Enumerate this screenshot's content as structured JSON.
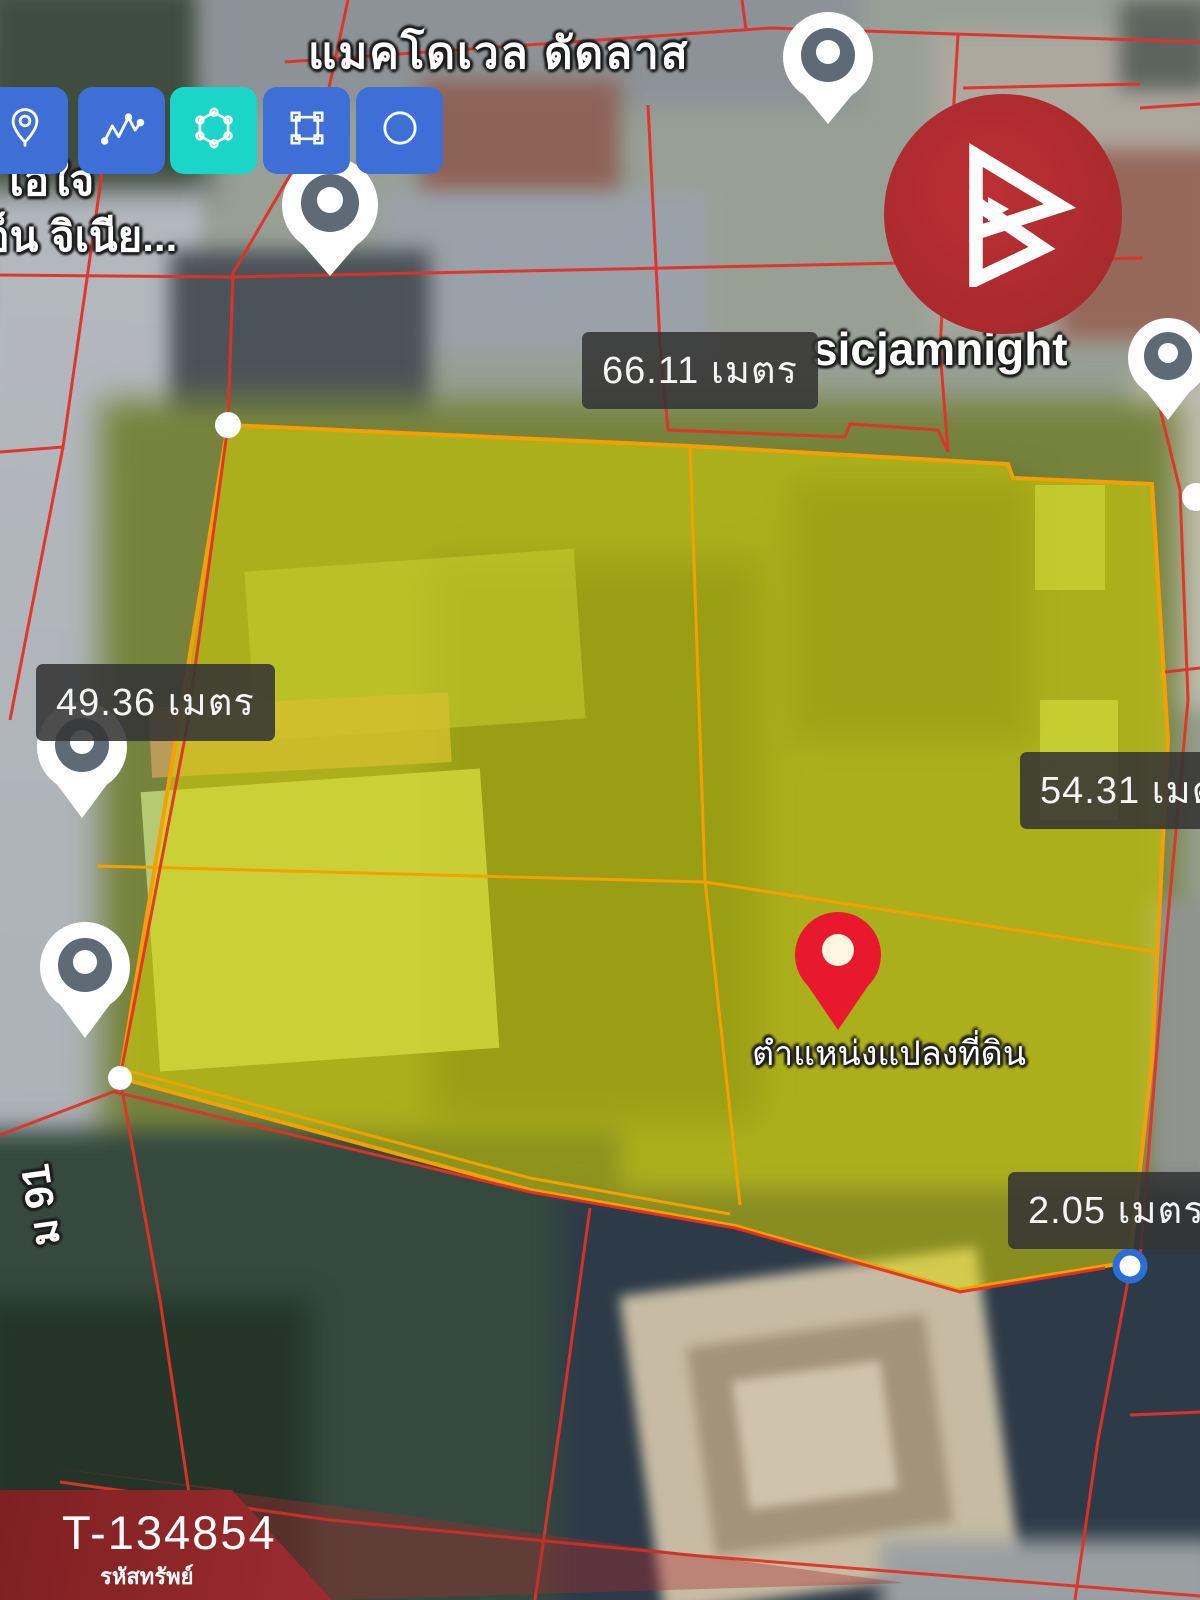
{
  "window": {
    "width": 1200,
    "height": 1600
  },
  "toolbar": {
    "button_color": "#3d6fd6",
    "active_color": "#1bd6c8",
    "tools": [
      {
        "id": "marker",
        "icon": "location-pin-icon",
        "active": false
      },
      {
        "id": "polyline",
        "icon": "polyline-icon",
        "active": false
      },
      {
        "id": "polygon",
        "icon": "polygon-icon",
        "active": true
      },
      {
        "id": "rectangle",
        "icon": "rectangle-icon",
        "active": false
      },
      {
        "id": "circle",
        "icon": "circle-icon",
        "active": false
      }
    ]
  },
  "map": {
    "street_label_top": "แมคโดเวล ดัดลาส",
    "place_label_right": "sicjamnight",
    "place_label_left_line1": "ล เอใจ",
    "place_label_left_line2": "เอ็น จิเนีย...",
    "road_label_left": "ม 91",
    "parcel_pin_label": "ตำแหน่งแปลงที่ดิน",
    "measurements": [
      {
        "side": "top",
        "text": "66.11 เมตร"
      },
      {
        "side": "left",
        "text": "49.36 เมตร"
      },
      {
        "side": "right",
        "text": "54.31 เมตร"
      },
      {
        "side": "bottom",
        "text": "2.05 เมตร"
      }
    ],
    "parcel_fill": "#dcd800",
    "parcel_outline": "#f59f00",
    "cadastral_line_color": "#e23128",
    "location_pin_color": "#e8192c"
  },
  "branding": {
    "logo": "triangle-b-logo",
    "logo_bg": "#a2272b"
  },
  "property": {
    "code": "T-134854",
    "code_caption": "รหัสทรัพย์",
    "banner_color": "#a93136"
  }
}
